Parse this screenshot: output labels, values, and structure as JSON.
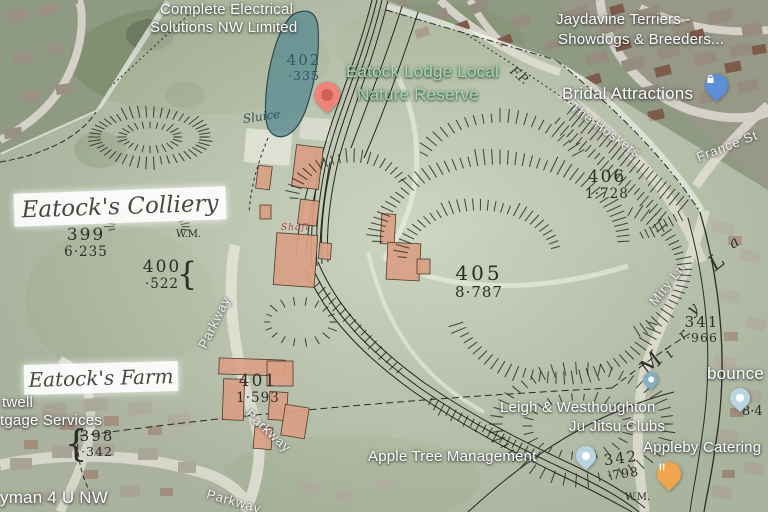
{
  "colors": {
    "pond": "#5f8d92",
    "paper": "#e3e9d6",
    "historic_building": "#d9a084",
    "pin_red": "#ee8578",
    "pin_red_dot": "#cf6254",
    "pin_blue": "#5b8fd6",
    "pin_orange": "#f0a54c",
    "pin_pale": "#b9d6e0",
    "pin_teal": "#86aec2",
    "reserve_green": "#a6d9b0",
    "linework": "#22201d"
  },
  "google": {
    "places": {
      "complete_electrical": {
        "line1": "Complete Electrical",
        "line2": "Solutions NW Limited"
      },
      "jaydavine": {
        "line1": "Jaydavine Terriers -",
        "line2": "Showdogs & Breeders..."
      },
      "bridal_attractions": {
        "label": "Bridal Attractions"
      },
      "nature_reserve": {
        "line1": "Eatock Lodge Local",
        "line2": "Nature Reserve"
      },
      "ju_jitsu": {
        "line1": "Leigh & Westhoughton",
        "line2": "Ju Jitsu Clubs"
      },
      "appleby_catering": {
        "label": "Appleby Catering"
      },
      "apple_tree": {
        "label": "Apple Tree Management"
      },
      "bounce": {
        "label": "bounce"
      },
      "mortgage_services": {
        "line1": "twell",
        "line2": "tgage Services"
      },
      "handyman": {
        "label": "yman 4 U NW"
      }
    },
    "roads": {
      "the_hoskers": "The Hoskers",
      "france_st": "France St",
      "miry_ln": "Miry Ln",
      "parkway": "Parkway"
    }
  },
  "historic_map": {
    "colliery_label": "Eatock's Colliery",
    "farm_label": "Eatock's Farm",
    "sluice": "Sluice",
    "shaft": "Shaft",
    "footpath_abbrev": "F.P.",
    "weighing_machine_abbrev": "W.M.",
    "partial_acreage": "8·4",
    "street_name_letters": [
      {
        "ch": "M",
        "x": 644,
        "y": 360,
        "rot": -48,
        "size": 22
      },
      {
        "ch": "i",
        "x": 667,
        "y": 346,
        "rot": -46,
        "size": 15
      },
      {
        "ch": "r",
        "x": 680,
        "y": 328,
        "rot": -44,
        "size": 15
      },
      {
        "ch": "y",
        "x": 689,
        "y": 302,
        "rot": -42,
        "size": 16
      },
      {
        "ch": "L",
        "x": 711,
        "y": 254,
        "rot": -38,
        "size": 21
      },
      {
        "ch": "a",
        "x": 730,
        "y": 236,
        "rot": -36,
        "size": 15
      }
    ],
    "parcels": [
      {
        "num": "402",
        "acreage": "·335",
        "x": 304,
        "y": 52,
        "cls": "sm teal"
      },
      {
        "num": "399",
        "acreage": "6·235",
        "x": 86,
        "y": 226,
        "cls": ""
      },
      {
        "num": "400",
        "acreage": "·522",
        "x": 162,
        "y": 258,
        "cls": "",
        "brace": "right"
      },
      {
        "num": "405",
        "acreage": "8·787",
        "x": 479,
        "y": 262,
        "cls": "lg"
      },
      {
        "num": "406",
        "acreage": "1·728",
        "x": 607,
        "y": 168,
        "cls": ""
      },
      {
        "num": "401",
        "acreage": "1·593",
        "x": 258,
        "y": 372,
        "cls": ""
      },
      {
        "num": "398",
        "acreage": "·342",
        "x": 97,
        "y": 428,
        "cls": "sm",
        "brace": "left"
      },
      {
        "num": "341",
        "acreage": "·966",
        "x": 702,
        "y": 314,
        "cls": "sm"
      },
      {
        "num": "342",
        "acreage": "·798",
        "x": 622,
        "y": 450,
        "cls": "sm",
        "tilt": -8
      }
    ]
  }
}
